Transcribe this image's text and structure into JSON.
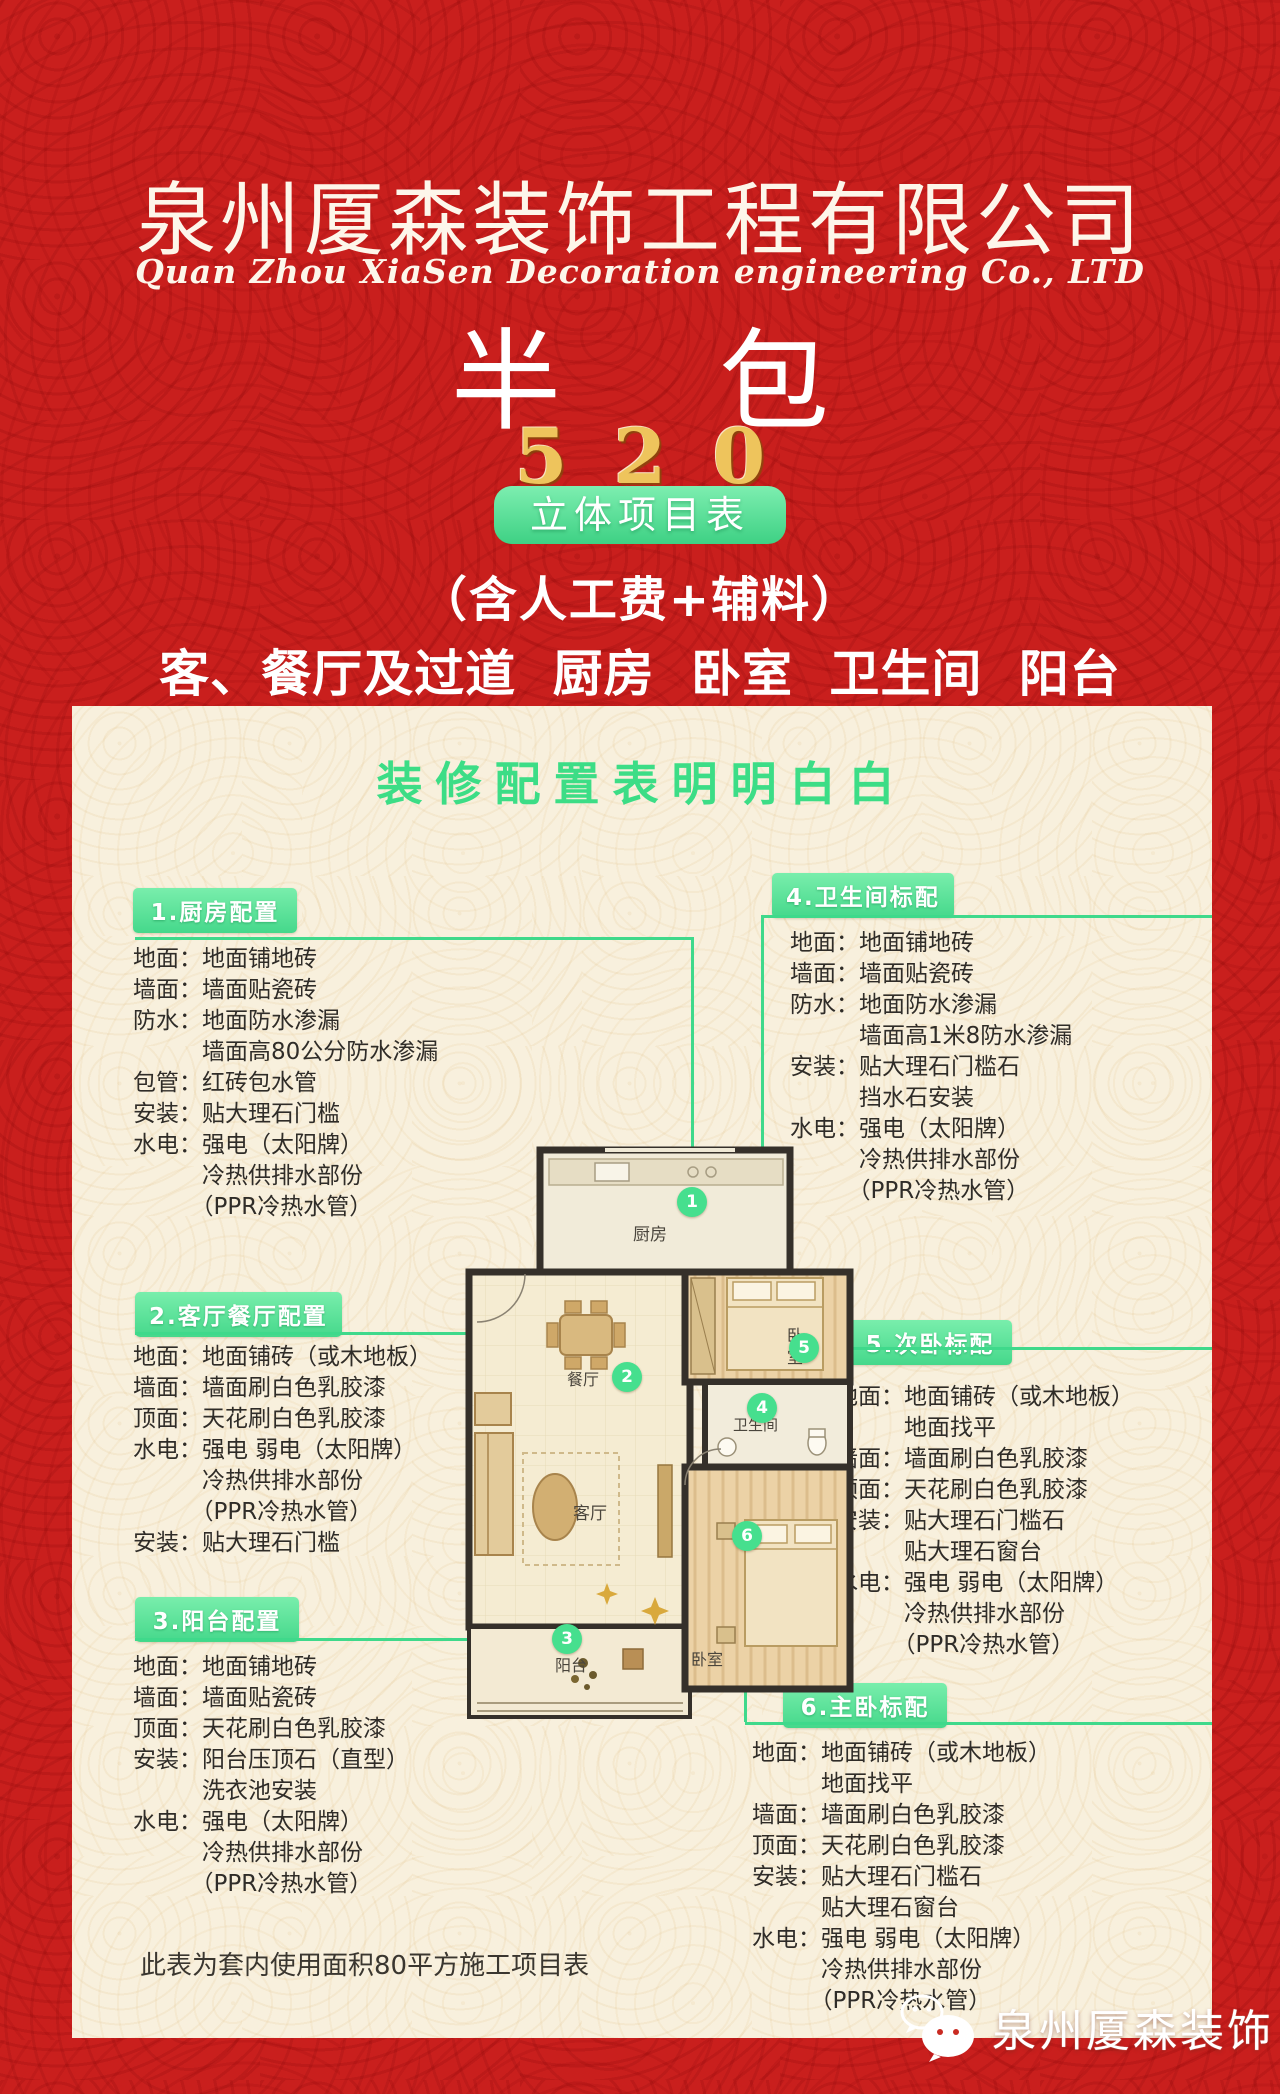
{
  "header": {
    "company_cn": "泉州厦森装饰工程有限公司",
    "company_en": "Quan Zhou XiaSen Decoration engineering Co., LTD",
    "package_type": "半　包",
    "price": "520",
    "badge_label": "立体项目表",
    "includes_line": "（含人工费+辅料）",
    "rooms_line": "客、餐厅及过道 厨房 卧室 卫生间 阳台"
  },
  "card": {
    "title": "装修配置表明明白白",
    "footnote": "此表为套内使用面积80平方施工项目表",
    "sections": [
      {
        "title": "1.厨房配置",
        "lines": [
          "地面：地面铺地砖",
          "墙面：墙面贴瓷砖",
          "防水：地面防水渗漏",
          "　　　墙面高80公分防水渗漏",
          "包管：红砖包水管",
          "安装：贴大理石门槛",
          "水电：强电（太阳牌）",
          "　　　冷热供排水部份",
          "　　　（PPR冷热水管）"
        ]
      },
      {
        "title": "2.客厅餐厅配置",
        "lines": [
          "地面：地面铺砖（或木地板）",
          "墙面：墙面刷白色乳胶漆",
          "顶面：天花刷白色乳胶漆",
          "水电：强电 弱电（太阳牌）",
          "　　　冷热供排水部份",
          "　　　（PPR冷热水管）",
          "安装：贴大理石门槛"
        ]
      },
      {
        "title": "3.阳台配置",
        "lines": [
          "地面：地面铺地砖",
          "墙面：墙面贴瓷砖",
          "顶面：天花刷白色乳胶漆",
          "安装：阳台压顶石（直型）",
          "　　　洗衣池安装",
          "水电：强电（太阳牌）",
          "　　　冷热供排水部份",
          "　　　（PPR冷热水管）"
        ]
      },
      {
        "title": "4.卫生间标配",
        "lines": [
          "地面：地面铺地砖",
          "墙面：墙面贴瓷砖",
          "防水：地面防水渗漏",
          "　　　墙面高1米8防水渗漏",
          "安装：贴大理石门槛石",
          "　　　挡水石安装",
          "水电：强电（太阳牌）",
          "　　　冷热供排水部份",
          "　　　（PPR冷热水管）"
        ]
      },
      {
        "title": "5.次卧标配",
        "lines": [
          "地面：地面铺砖（或木地板）",
          "　　　地面找平",
          "墙面：墙面刷白色乳胶漆",
          "顶面：天花刷白色乳胶漆",
          "安装：贴大理石门槛石",
          "　　　贴大理石窗台",
          "水电：强电 弱电（太阳牌）",
          "　　　冷热供排水部份",
          "　　　（PPR冷热水管）"
        ]
      },
      {
        "title": "6.主卧标配",
        "lines": [
          "地面：地面铺砖（或木地板）",
          "　　　地面找平",
          "墙面：墙面刷白色乳胶漆",
          "顶面：天花刷白色乳胶漆",
          "安装：贴大理石门槛石",
          "　　　贴大理石窗台",
          "水电：强电 弱电（太阳牌）",
          "　　　冷热供排水部份",
          "　　　（PPR冷热水管）"
        ]
      }
    ]
  },
  "floorplan": {
    "rooms": {
      "kitchen": "厨房",
      "dining": "餐厅",
      "bedroom_top_1": "卧",
      "bedroom_top_2": "室",
      "bathroom": "卫生间",
      "living": "客厅",
      "bedroom_bottom": "卧室",
      "balcony": "阳台"
    },
    "markers": [
      "1",
      "2",
      "3",
      "4",
      "5",
      "6"
    ]
  },
  "footer": {
    "brand": "泉州厦森装饰",
    "icon": "wechat-icon"
  },
  "colors": {
    "background_red": "#c91f1d",
    "card_cream": "#f8f0dd",
    "accent_green": "#3ed184",
    "gold": "#eec45c"
  }
}
